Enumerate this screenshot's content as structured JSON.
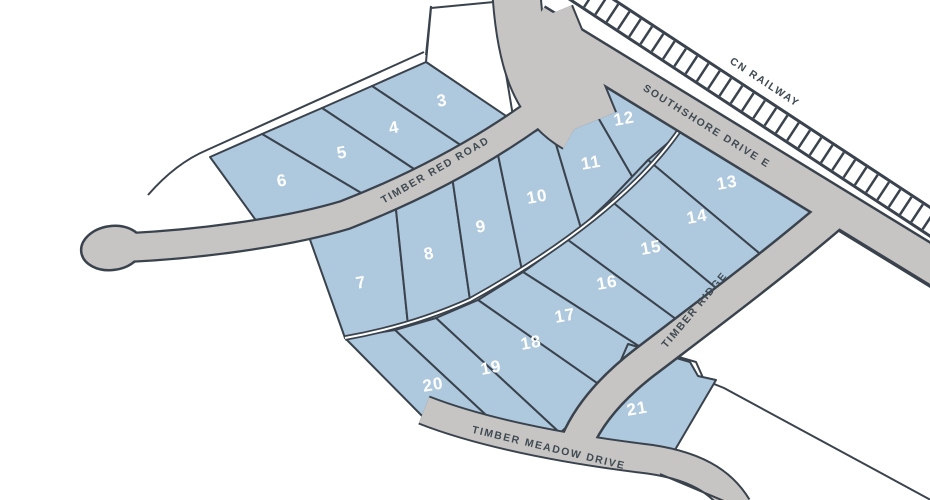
{
  "map": {
    "title": "subdivision-lot-map",
    "streets": {
      "railway": "CN RAILWAY",
      "southshore": "SOUTHSHORE DRIVE E",
      "timber_red": "TIMBER RED ROAD",
      "timber_ridge": "TIMBER RIDGE",
      "timber_meadow": "TIMBER MEADOW DRIVE"
    },
    "lots": {
      "lot3": "3",
      "lot4": "4",
      "lot5": "5",
      "lot6": "6",
      "lot7": "7",
      "lot8": "8",
      "lot9": "9",
      "lot10": "10",
      "lot11": "11",
      "lot12": "12",
      "lot13": "13",
      "lot14": "14",
      "lot15": "15",
      "lot16": "16",
      "lot17": "17",
      "lot18": "18",
      "lot19": "19",
      "lot20": "20",
      "lot21": "21"
    },
    "colors": {
      "lot_fill": "#aec8de",
      "road_fill": "#c7c5c3",
      "outline": "#3a434d",
      "lot_number_text": "#ffffff",
      "street_label_text": "#3f4a52",
      "background": "#ffffff"
    }
  }
}
